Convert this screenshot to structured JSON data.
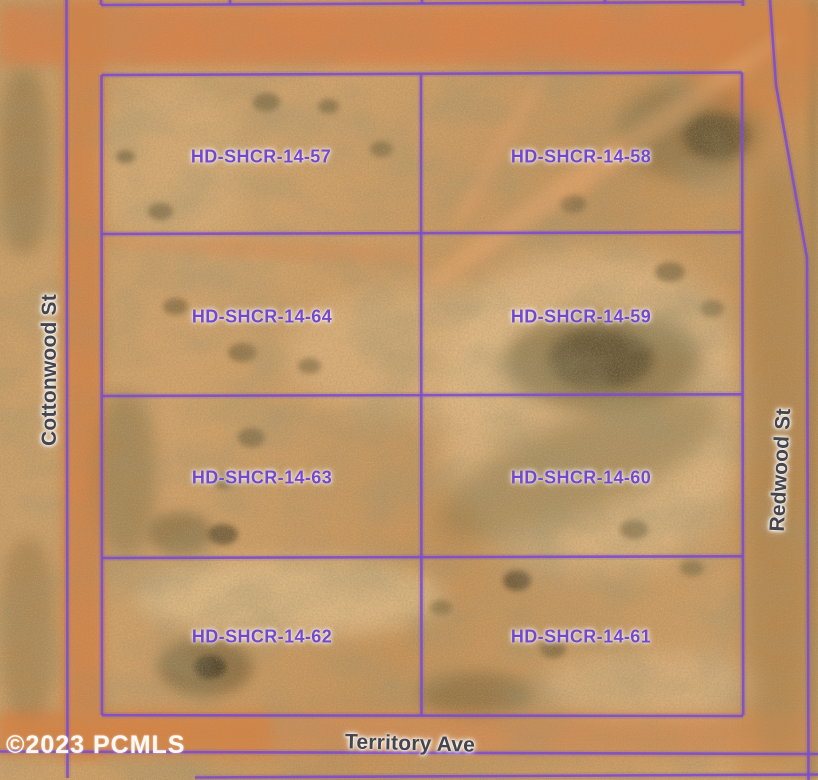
{
  "map": {
    "watermark": "©2023 PCMLS",
    "streets": {
      "west": "Cottonwood St",
      "east": "Redwood St",
      "south": "Territory Ave"
    },
    "parcels": [
      {
        "label": "HD-SHCR-14-57",
        "grid": "row1-west"
      },
      {
        "label": "HD-SHCR-14-58",
        "grid": "row1-east"
      },
      {
        "label": "HD-SHCR-14-64",
        "grid": "row2-west"
      },
      {
        "label": "HD-SHCR-14-59",
        "grid": "row2-east"
      },
      {
        "label": "HD-SHCR-14-63",
        "grid": "row3-west"
      },
      {
        "label": "HD-SHCR-14-60",
        "grid": "row3-east"
      },
      {
        "label": "HD-SHCR-14-62",
        "grid": "row4-west"
      },
      {
        "label": "HD-SHCR-14-61",
        "grid": "row4-east"
      }
    ],
    "colors": {
      "boundary_line": "#7d4ec9",
      "parcel_label": "#7448cc",
      "street_label": "#45454e",
      "watermark_text": "#ffffff"
    }
  }
}
